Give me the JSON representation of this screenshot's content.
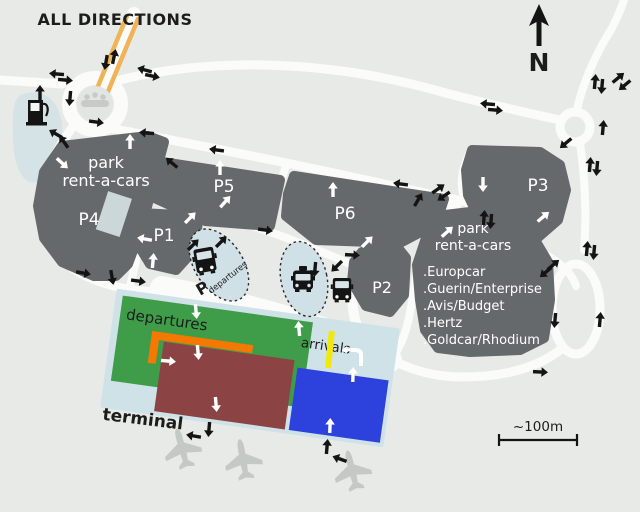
{
  "title": "ALL DIRECTIONS",
  "compass": {
    "north_label": "N"
  },
  "scale": {
    "label": "~100m"
  },
  "parking": {
    "left": {
      "line1": "park",
      "line2": "rent-a-cars",
      "p4": "P4"
    },
    "right": {
      "line1": "park",
      "line2": "rent-a-cars"
    },
    "p1": "P1",
    "p2": "P2",
    "p3": "P3",
    "p5": "P5",
    "p6": "P6"
  },
  "rental_companies": [
    ".Europcar",
    ".Guerin/Enterprise",
    ".Avis/Budget",
    ".Hertz",
    ".Goldcar/Rhodium"
  ],
  "terminal": {
    "name": "terminal",
    "departures": "departures",
    "arrivals": "arrivals"
  },
  "shuttle_stop": {
    "p": "P",
    "label": "departures"
  },
  "icons": {
    "north_arrow": "north-arrow-icon",
    "fuel_pump": "fuel-pump-icon",
    "bus": "bus-icon",
    "taxi": "taxi-icon",
    "airplane": "airplane-icon",
    "people_monument": "people-monument-icon"
  },
  "colors": {
    "background": "#e8eae7",
    "road": "#fbfcfa",
    "parking_gray": "#66696b",
    "terminal_base": "#cfe2e8",
    "departures_green": "#3f9d4a",
    "terminal_red": "#8c4343",
    "terminal_blue": "#2d42dd",
    "orange_band": "#f57900",
    "orange_road": "#efb457",
    "yellow_bar": "#f2e90c",
    "zone_blue": "#cfe0e6"
  }
}
